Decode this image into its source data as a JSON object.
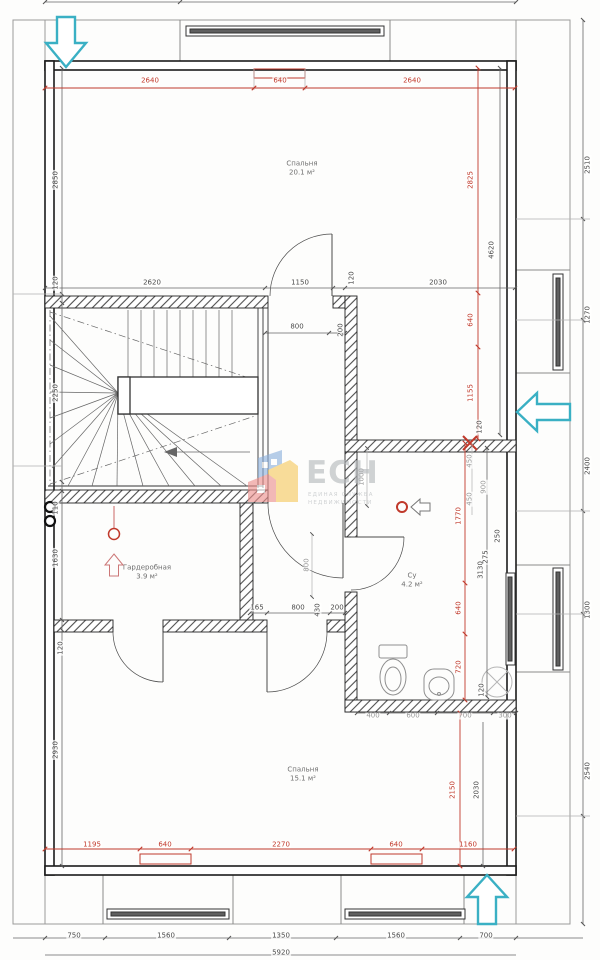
{
  "document": {
    "kind": "architectural floor plan",
    "units": "mm"
  },
  "logo": {
    "abbr": "ЕСН",
    "tagline_line1": "ЕДИНАЯ СЛУЖБА",
    "tagline_line2": "НЕДВИЖИМОСТИ"
  },
  "colors": {
    "dimension_red": "#c0392b",
    "dimension_black": "#4a4a4a",
    "dimension_gray": "#9b9b9b",
    "wall": "#1c1c1c",
    "entry_arrow_cyan": "#3ab0c4",
    "logo_blue": "#8cb0dd",
    "logo_yellow": "#f6c95e",
    "logo_salmon": "#ec8f8c",
    "logo_gray": "#b4b8bb"
  },
  "rooms": [
    {
      "name": "Спальня",
      "area": "20.1 м²",
      "x": 302,
      "y": 168
    },
    {
      "name": "Гардеробная",
      "area": "3.9 м²",
      "x": 147,
      "y": 572
    },
    {
      "name": "Су",
      "area": "4.2 м²",
      "x": 412,
      "y": 580
    },
    {
      "name": "Спальня",
      "area": "15.1 м²",
      "x": 303,
      "y": 774
    }
  ],
  "dimensions": [
    {
      "t": "2640",
      "x": 150,
      "y": 81,
      "v": false,
      "c": "red"
    },
    {
      "t": "640",
      "x": 280,
      "y": 81,
      "v": false,
      "c": "red"
    },
    {
      "t": "2640",
      "x": 412,
      "y": 81,
      "v": false,
      "c": "red"
    },
    {
      "t": "2620",
      "x": 152,
      "y": 283,
      "v": false,
      "c": "blk"
    },
    {
      "t": "1150",
      "x": 300,
      "y": 283,
      "v": false,
      "c": "blk"
    },
    {
      "t": "120",
      "x": 352,
      "y": 278,
      "v": true,
      "c": "blk"
    },
    {
      "t": "2030",
      "x": 438,
      "y": 283,
      "v": false,
      "c": "blk"
    },
    {
      "t": "800",
      "x": 297,
      "y": 327,
      "v": false,
      "c": "blk"
    },
    {
      "t": "200",
      "x": 341,
      "y": 330,
      "v": true,
      "c": "blk"
    },
    {
      "t": "2850",
      "x": 56,
      "y": 180,
      "v": true,
      "c": "blk"
    },
    {
      "t": "120",
      "x": 56,
      "y": 283,
      "v": true,
      "c": "blk"
    },
    {
      "t": "2250",
      "x": 56,
      "y": 393,
      "v": true,
      "c": "blk"
    },
    {
      "t": "110",
      "x": 56,
      "y": 508,
      "v": true,
      "c": "blk"
    },
    {
      "t": "1630",
      "x": 56,
      "y": 558,
      "v": true,
      "c": "blk"
    },
    {
      "t": "120",
      "x": 61,
      "y": 648,
      "v": true,
      "c": "blk"
    },
    {
      "t": "2930",
      "x": 56,
      "y": 750,
      "v": true,
      "c": "blk"
    },
    {
      "t": "2825",
      "x": 471,
      "y": 180,
      "v": true,
      "c": "red"
    },
    {
      "t": "640",
      "x": 471,
      "y": 320,
      "v": true,
      "c": "red"
    },
    {
      "t": "1155",
      "x": 471,
      "y": 393,
      "v": true,
      "c": "red"
    },
    {
      "t": "1770",
      "x": 459,
      "y": 516,
      "v": true,
      "c": "red"
    },
    {
      "t": "640",
      "x": 459,
      "y": 608,
      "v": true,
      "c": "red"
    },
    {
      "t": "720",
      "x": 459,
      "y": 667,
      "v": true,
      "c": "red"
    },
    {
      "t": "2150",
      "x": 453,
      "y": 790,
      "v": true,
      "c": "red"
    },
    {
      "t": "4620",
      "x": 492,
      "y": 250,
      "v": true,
      "c": "blk"
    },
    {
      "t": "120",
      "x": 480,
      "y": 427,
      "v": true,
      "c": "blk"
    },
    {
      "t": "3130",
      "x": 481,
      "y": 570,
      "v": true,
      "c": "blk"
    },
    {
      "t": "250",
      "x": 498,
      "y": 536,
      "v": true,
      "c": "blk"
    },
    {
      "t": "275",
      "x": 486,
      "y": 557,
      "v": true,
      "c": "blk"
    },
    {
      "t": "120",
      "x": 482,
      "y": 690,
      "v": true,
      "c": "blk"
    },
    {
      "t": "2030",
      "x": 477,
      "y": 790,
      "v": true,
      "c": "blk"
    },
    {
      "t": "450",
      "x": 470,
      "y": 461,
      "v": true,
      "c": "gry"
    },
    {
      "t": "900",
      "x": 484,
      "y": 487,
      "v": true,
      "c": "gry"
    },
    {
      "t": "450",
      "x": 470,
      "y": 499,
      "v": true,
      "c": "gry"
    },
    {
      "t": "1000",
      "x": 362,
      "y": 477,
      "v": true,
      "c": "gry"
    },
    {
      "t": "800",
      "x": 307,
      "y": 565,
      "v": true,
      "c": "gry"
    },
    {
      "t": "165",
      "x": 257,
      "y": 608,
      "v": false,
      "c": "blk"
    },
    {
      "t": "800",
      "x": 298,
      "y": 608,
      "v": false,
      "c": "blk"
    },
    {
      "t": "430",
      "x": 318,
      "y": 610,
      "v": true,
      "c": "blk"
    },
    {
      "t": "200",
      "x": 337,
      "y": 608,
      "v": false,
      "c": "blk"
    },
    {
      "t": "400",
      "x": 373,
      "y": 716,
      "v": false,
      "c": "gry"
    },
    {
      "t": "600",
      "x": 413,
      "y": 716,
      "v": false,
      "c": "gry"
    },
    {
      "t": "700",
      "x": 465,
      "y": 716,
      "v": false,
      "c": "gry"
    },
    {
      "t": "300",
      "x": 505,
      "y": 716,
      "v": false,
      "c": "gry"
    },
    {
      "t": "2510",
      "x": 588,
      "y": 165,
      "v": true,
      "c": "blk"
    },
    {
      "t": "1270",
      "x": 588,
      "y": 315,
      "v": true,
      "c": "blk"
    },
    {
      "t": "2400",
      "x": 588,
      "y": 466,
      "v": true,
      "c": "blk"
    },
    {
      "t": "1300",
      "x": 588,
      "y": 610,
      "v": true,
      "c": "blk"
    },
    {
      "t": "2540",
      "x": 588,
      "y": 771,
      "v": true,
      "c": "blk"
    },
    {
      "t": "1195",
      "x": 92,
      "y": 845,
      "v": false,
      "c": "red"
    },
    {
      "t": "640",
      "x": 165,
      "y": 845,
      "v": false,
      "c": "red"
    },
    {
      "t": "2270",
      "x": 281,
      "y": 845,
      "v": false,
      "c": "red"
    },
    {
      "t": "640",
      "x": 396,
      "y": 845,
      "v": false,
      "c": "red"
    },
    {
      "t": "1160",
      "x": 468,
      "y": 845,
      "v": false,
      "c": "red"
    },
    {
      "t": "750",
      "x": 74,
      "y": 936,
      "v": false,
      "c": "blk"
    },
    {
      "t": "1560",
      "x": 166,
      "y": 936,
      "v": false,
      "c": "blk"
    },
    {
      "t": "1350",
      "x": 281,
      "y": 936,
      "v": false,
      "c": "blk"
    },
    {
      "t": "1560",
      "x": 396,
      "y": 936,
      "v": false,
      "c": "blk"
    },
    {
      "t": "700",
      "x": 486,
      "y": 936,
      "v": false,
      "c": "blk"
    },
    {
      "t": "5920",
      "x": 281,
      "y": 953,
      "v": false,
      "c": "blk"
    }
  ]
}
